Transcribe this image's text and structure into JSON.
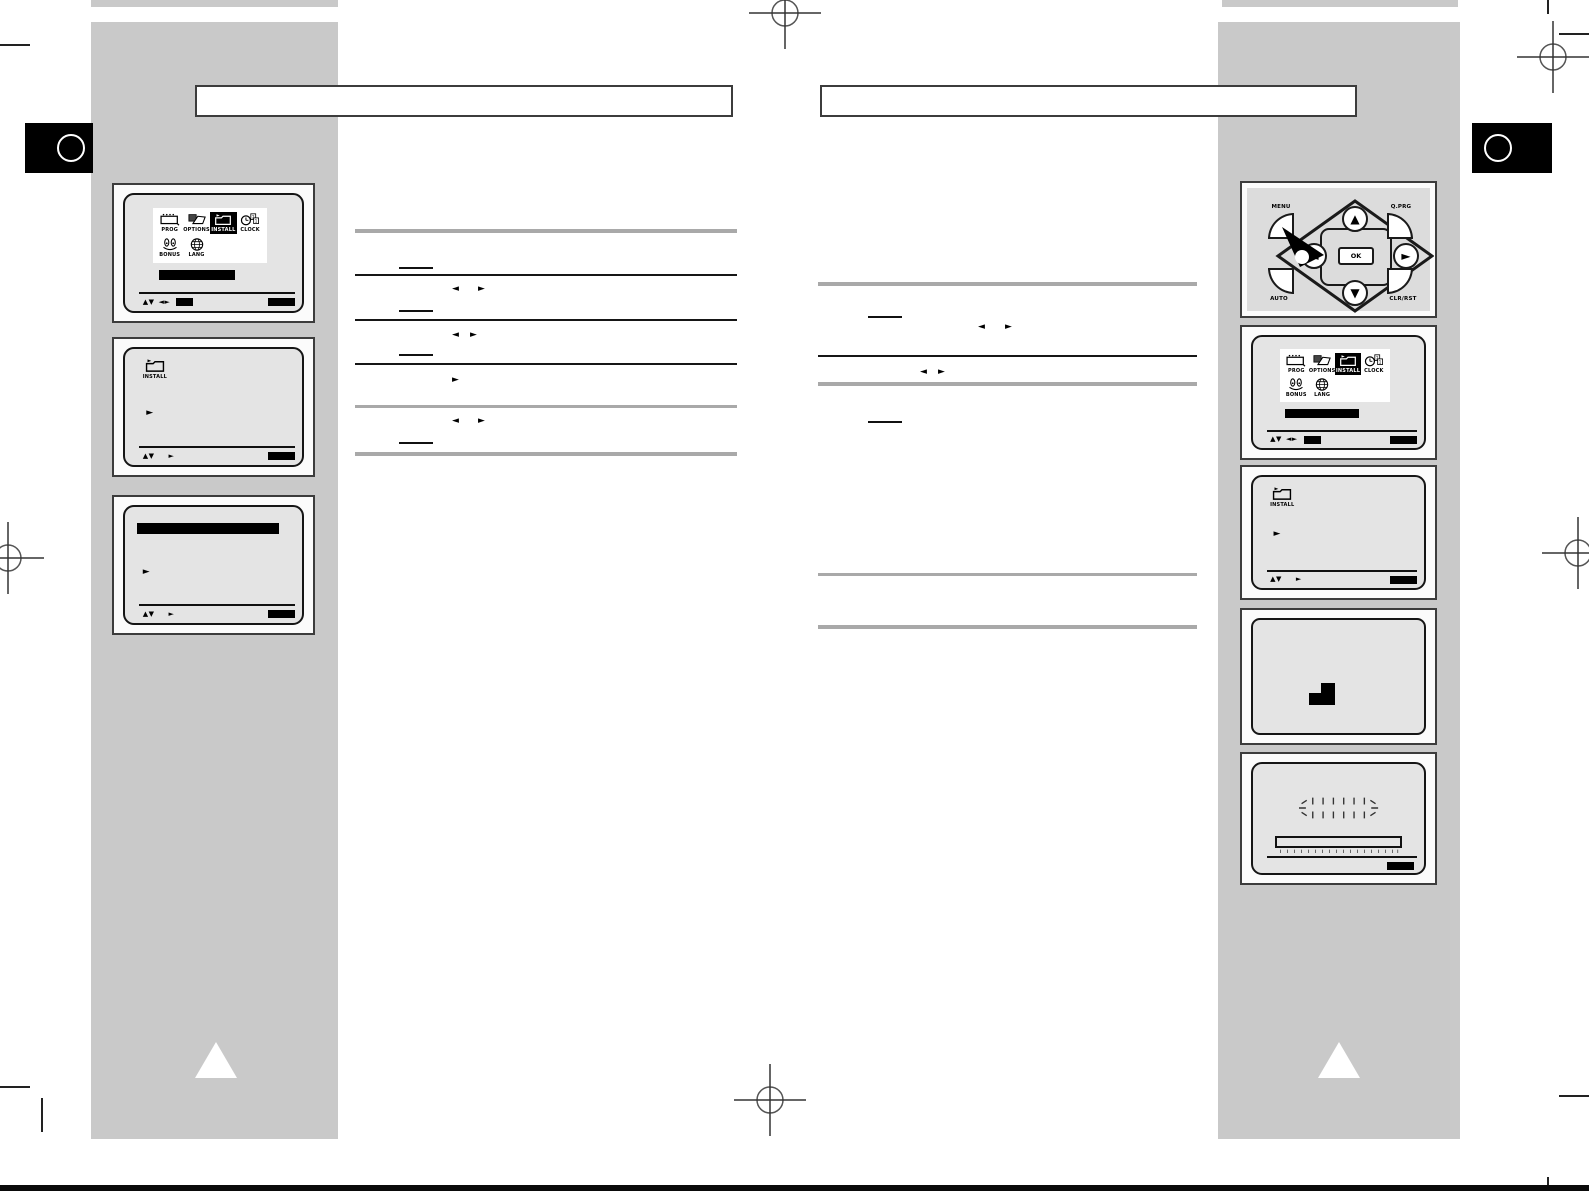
{
  "screens": {
    "main_menu": {
      "icons": [
        {
          "label": "PROG"
        },
        {
          "label": "OPTIONS"
        },
        {
          "label": "INSTALL"
        },
        {
          "label": "CLOCK"
        },
        {
          "label": "BONUS"
        },
        {
          "label": "LANG"
        }
      ],
      "selected_icon": "INSTALL",
      "status": {
        "updown": "▲▼",
        "leftright": "◄►"
      }
    },
    "install_menu": {
      "icon_label": "INSTALL",
      "cursor": "►",
      "status": {
        "updown": "▲▼",
        "cursor": "►"
      }
    },
    "sub_menu": {
      "cursor": "►",
      "status": {
        "updown": "▲▼",
        "cursor": "►"
      }
    }
  },
  "remote": {
    "menu": "MENU",
    "qprg": "Q.PRG",
    "auto": "AUTO",
    "clrrst": "CLR/RST",
    "ok": "OK",
    "up": "▲",
    "down": "▼",
    "left": "◄",
    "right": "►"
  },
  "instructions": {
    "larr": "◄",
    "rarr": "►"
  },
  "colors": {
    "sidebar": "#c9c9c9",
    "screen_bg": "#e4e4e4",
    "remote_bg": "#dcdcdc",
    "separator_gray": "#a9a9a9",
    "ink": "#000000"
  }
}
